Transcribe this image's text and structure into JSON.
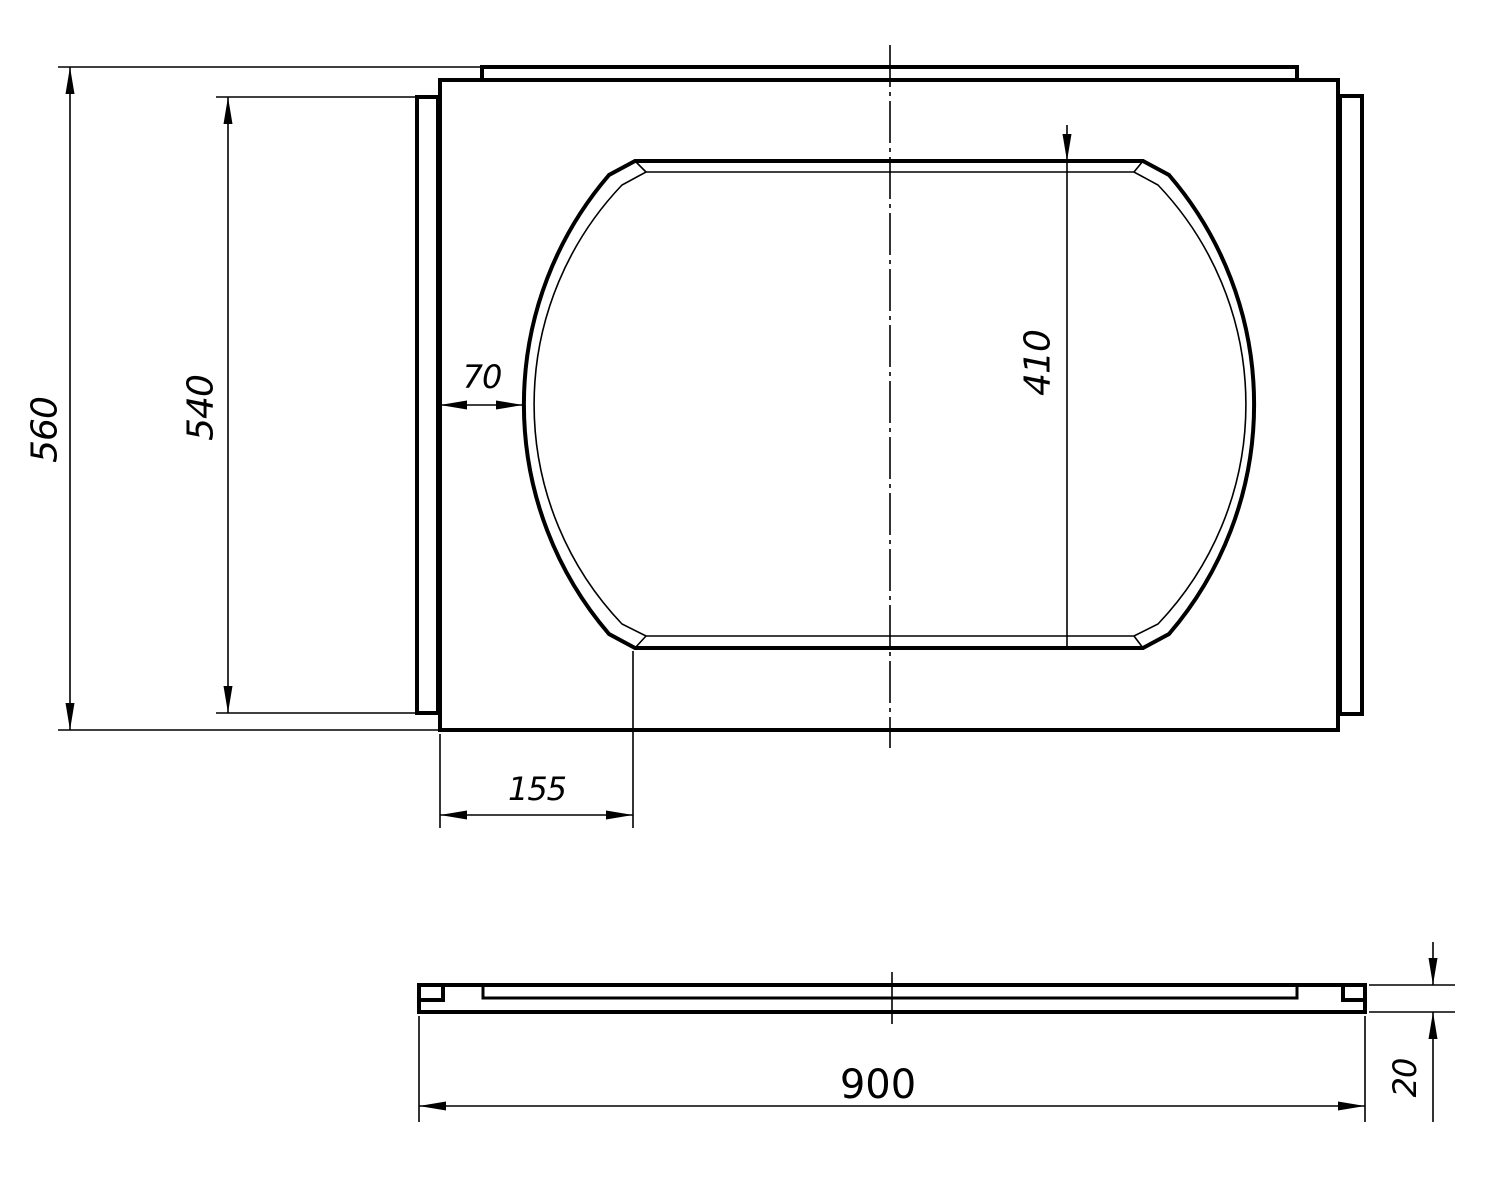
{
  "colors": {
    "line": "#000000",
    "background": "#ffffff"
  },
  "dimensions": {
    "overall_height": "560",
    "side_panel_height": "540",
    "cutout_left_offset": "70",
    "cutout_height": "410",
    "cutout_bottom_left_offset": "155",
    "overall_length": "900",
    "thickness": "20"
  }
}
